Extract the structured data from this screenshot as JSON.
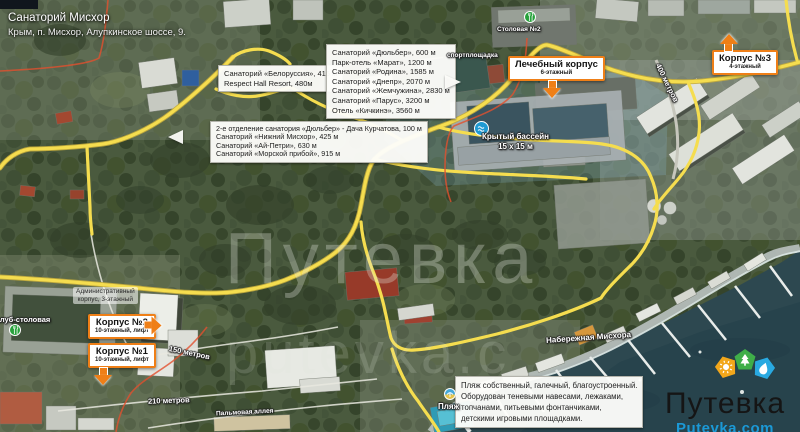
{
  "header": {
    "title": "Санаторий Мисхор",
    "subtitle": "Крым, п. Мисхор, Алупкинское шоссе, 9."
  },
  "callouts": {
    "belorussia": {
      "lines": [
        "Санаторий «Белоруссия», 415 м",
        "Respect Hall Resort, 480м"
      ]
    },
    "far_list": {
      "lines": [
        "Санаторий «Дюльбер», 600 м",
        "Парк-отель «Марат», 1200 м",
        "Санаторий «Родина», 1585 м",
        "Санаторий «Днепр», 2070 м",
        "Санаторий «Жемчужина», 2830 м",
        "Санаторий «Парус», 3200 м",
        "Отель «Кичкинэ», 3560 м"
      ]
    },
    "near_list": {
      "lines": [
        "2-е отделение санатория «Дюльбер» - Дача Курчатова, 100 м",
        "Санаторий «Нижний Мисхор», 425 м",
        "Санаторий «Ай-Петри», 630 м",
        "Санаторий «Морской прибой», 915 м"
      ]
    },
    "medical": {
      "title": "Лечебный корпус",
      "subtitle": "6-этажный"
    },
    "korpus3": {
      "title": "Корпус №3",
      "subtitle": "4-этажный"
    },
    "korpus2": {
      "title": "Корпус №2",
      "subtitle": "10-этажный, лифт"
    },
    "korpus1": {
      "title": "Корпус №1",
      "subtitle": "10-этажный, лифт"
    },
    "admin": {
      "lines": [
        "Административный",
        "корпус, 3-этажный"
      ]
    },
    "beach_info": {
      "lines": [
        "Пляж собственный, галечный, благоустроенный.",
        "Оборудован теневыми навесами, лежаками,",
        "топчанами, питьевыми фонтанчиками,",
        "детскими игровыми площадками."
      ]
    }
  },
  "map_labels": {
    "sport_ground": "спортплощадка",
    "stolovaya": "Столовая №2",
    "club_stolovaya": "клуб-столовая",
    "pool": {
      "line1": "Крытый бассейн",
      "line2": "15 х 15 м"
    },
    "embankment": "Набережная Мисхора",
    "beach": "Пляж",
    "palm_alley": "Пальмовая аллея",
    "dist_150": "150 метров",
    "dist_210": "210 метров",
    "dist_400": "400 метров"
  },
  "watermark": {
    "big": "Путевка",
    "small": "putevka.c"
  },
  "logo": {
    "wordmark": "Путевка",
    "site": "Putevka.com"
  },
  "colors": {
    "road_yellow": "#f5dd4f",
    "callout_orange": "#ef7f17",
    "boundary_red": "#e2502e",
    "sea": "#2d4850",
    "logo_orange": "#f2a71b",
    "logo_green": "#3fae49",
    "logo_blue": "#29a9e1",
    "site_blue": "#1b99d6"
  }
}
